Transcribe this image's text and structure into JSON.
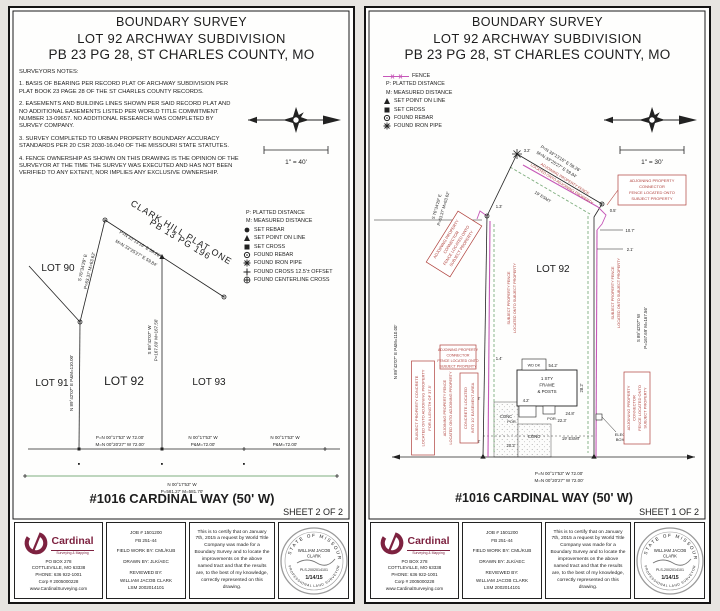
{
  "doc": {
    "title1": "BOUNDARY SURVEY",
    "title2": "LOT 92 ARCHWAY SUBDIVISION",
    "title3": "PB 23  PG 28, ST CHARLES COUNTY, MO",
    "street": "#1016 CARDINAL WAY (50' W)"
  },
  "bearings": {
    "ne_p": "P=N 33°13'16\" E  59.26'",
    "ne_m": "M=N 33°25'27\" E  59.84'",
    "nw1": "S 76°34'29\" E",
    "nw2": "P=63.37'  M=63.62'",
    "west": "N 89°42'07\" E   P&M=110.00'",
    "east1": "S 89°42'07\" W",
    "east2": "P=167.69'  M=167.56'",
    "f92p": "P=N 00°17'53\" W  72.00'",
    "f92m": "M=N 00°20'27\" W  72.00'",
    "f93a": "N 00°17'53\" W",
    "f93b": "P&M=72.00'",
    "cl1": "N 00°17'53\" W",
    "cl2": "P=581.27'  M=581.70'"
  },
  "sheet2": {
    "notes": [
      "SURVEYORS NOTES:",
      "1. BASIS OF BEARING PER RECORD PLAT OF ARCHWAY SUBDIVISION PER\nPLAT BOOK 23 PAGE 28 OF THE ST CHARLES COUNTY RECORDS.",
      "2. EASEMENTS AND BUILDING LINES SHOWN PER SAID RECORD PLAT AND\nNO ADDITIONAL EASEMENTS LISTED PER WORLD TITLE COMMITMENT\nNUMBER 13-09657.  NO ADDITIONAL RESEARCH WAS COMPLETED BY\nSURVEY COMPANY.",
      "3. SURVEY COMPLETED TO URBAN PROPERTY BOUNDARY ACCURACY\nSTANDARDS PER 20 CSR 2030-16.040 OF THE MISSOURI STATE STATUTES.",
      "4. FENCE OWNERSHIP AS SHOWN ON THIS DRAWING IS THE OPINION OF THE\nSURVEYOR AT THE TIME THE SURVEY WAS EXECUTED AND HAS NOT BEEN\nVERIFIED TO ANY EXTENT, NOR IMPLIES ANY EXCLUSIVE OWNERSHIP."
    ],
    "scale": "1\" = 40'",
    "legend": [
      "P: PLATTED DISTANCE",
      "M: MEASURED DISTANCE",
      "SET REBAR",
      "SET POINT ON LINE",
      "SET CROSS",
      "FOUND REBAR",
      "FOUND IRON PIPE",
      "FOUND CROSS 12.5'± OFFSET",
      "FOUND CENTERLINE CROSS"
    ],
    "plat": {
      "subdiv1": "CLARK HILL PLAT ONE",
      "subdiv2": "PB 13  PG 196",
      "lot90": "LOT 90",
      "lot91": "LOT 91",
      "lot92": "LOT 92",
      "lot93": "LOT 93"
    },
    "sheet_label": "SHEET 2 OF 2"
  },
  "sheet1": {
    "scale": "1\" = 30'",
    "legend": [
      "FENCE",
      "P: PLATTED DISTANCE",
      "M: MEASURED DISTANCE",
      "SET POINT ON LINE",
      "SET CROSS",
      "FOUND REBAR",
      "FOUND IRON PIPE"
    ],
    "lot92": "LOT 92",
    "esmt19": "19' ESMT",
    "red": {
      "adj_conn": [
        "ADJOINING PROPERTY",
        "CONNECTOR",
        "FENCE LOCATED ONTO",
        "SUBJECT PROPERTY"
      ],
      "adj_fence": [
        "ADJOINING PROPERTY FENCE",
        "LOCATED ONTO ADJOINING PROPERTY"
      ],
      "subj_fence": [
        "SUBJECT PROPERTY FENCE",
        "LOCATED ONTO SUBJECT PROPERTY"
      ],
      "subj_conc": [
        "SUBJECT PROPERTY CONCRETE",
        "LOCATED ONTO ADJOINING PROPERTY",
        "FOR A LENGTH OF 37.5'"
      ],
      "conc_esmt": [
        "CONCRETE LOCATED",
        "INTO 10' EASEMENT AREA"
      ]
    },
    "house": {
      "l1": "1 STY",
      "l2": "FRAME",
      "l3": "& POSTS",
      "wddk": "WD DK",
      "por": "POR.",
      "conc": "CONC",
      "elec1": "ELEC",
      "elec2": "BOX"
    },
    "dims": [
      "3.2'",
      "1.3'",
      "0.5'",
      "10.7'",
      "2.1'",
      "54.2'",
      "4.2'",
      "24.8'",
      "22.3'",
      "20.2'",
      "28.2'",
      "1.4'",
      "0.8'",
      "0.8'"
    ],
    "sheet_label": "SHEET 1 OF 2"
  },
  "titleblock": {
    "company": {
      "name": "Cardinal",
      "tagline": "Surveying & Mapping",
      "addr": [
        "PO BOX 278",
        "COTTLEVILLE, MO 63338",
        "PHONE: 636 922-1001",
        "Corp # 2005000228",
        "www.CardinalSurveying.com"
      ]
    },
    "job": [
      "JOB # 1501200",
      "FB 251-44",
      "FIELD WORK BY:  CML/KUB",
      "DRAWN BY:  JLK/AEC",
      "REVIEWED BY:",
      "WILLIAM JACOB CLARK",
      "LSM 2002014101"
    ],
    "cert": "This is to certify that on January 7th, 2015 a request by World Title Company was made for a Boundary Survey and to locate the improvements on the above named tract and that the results are, to the best of my knowledge, correctly represented on this drawing.",
    "seal": {
      "ring_top": "STATE OF MISSOURI",
      "ring_bottom": "PROFESSIONAL LAND SURVEYOR",
      "name1": "WILLIAM JACOB",
      "name2": "CLARK",
      "num": "PLS-2002014101",
      "date": "1/14/15"
    }
  },
  "colors": {
    "fence": "#c657b8",
    "easement": "#7fae7f",
    "annotation_red": "#b0413c",
    "logo_maroon": "#7d2240",
    "seal_gray": "#9a9a9a",
    "seal_date_red": "#c3342e"
  }
}
